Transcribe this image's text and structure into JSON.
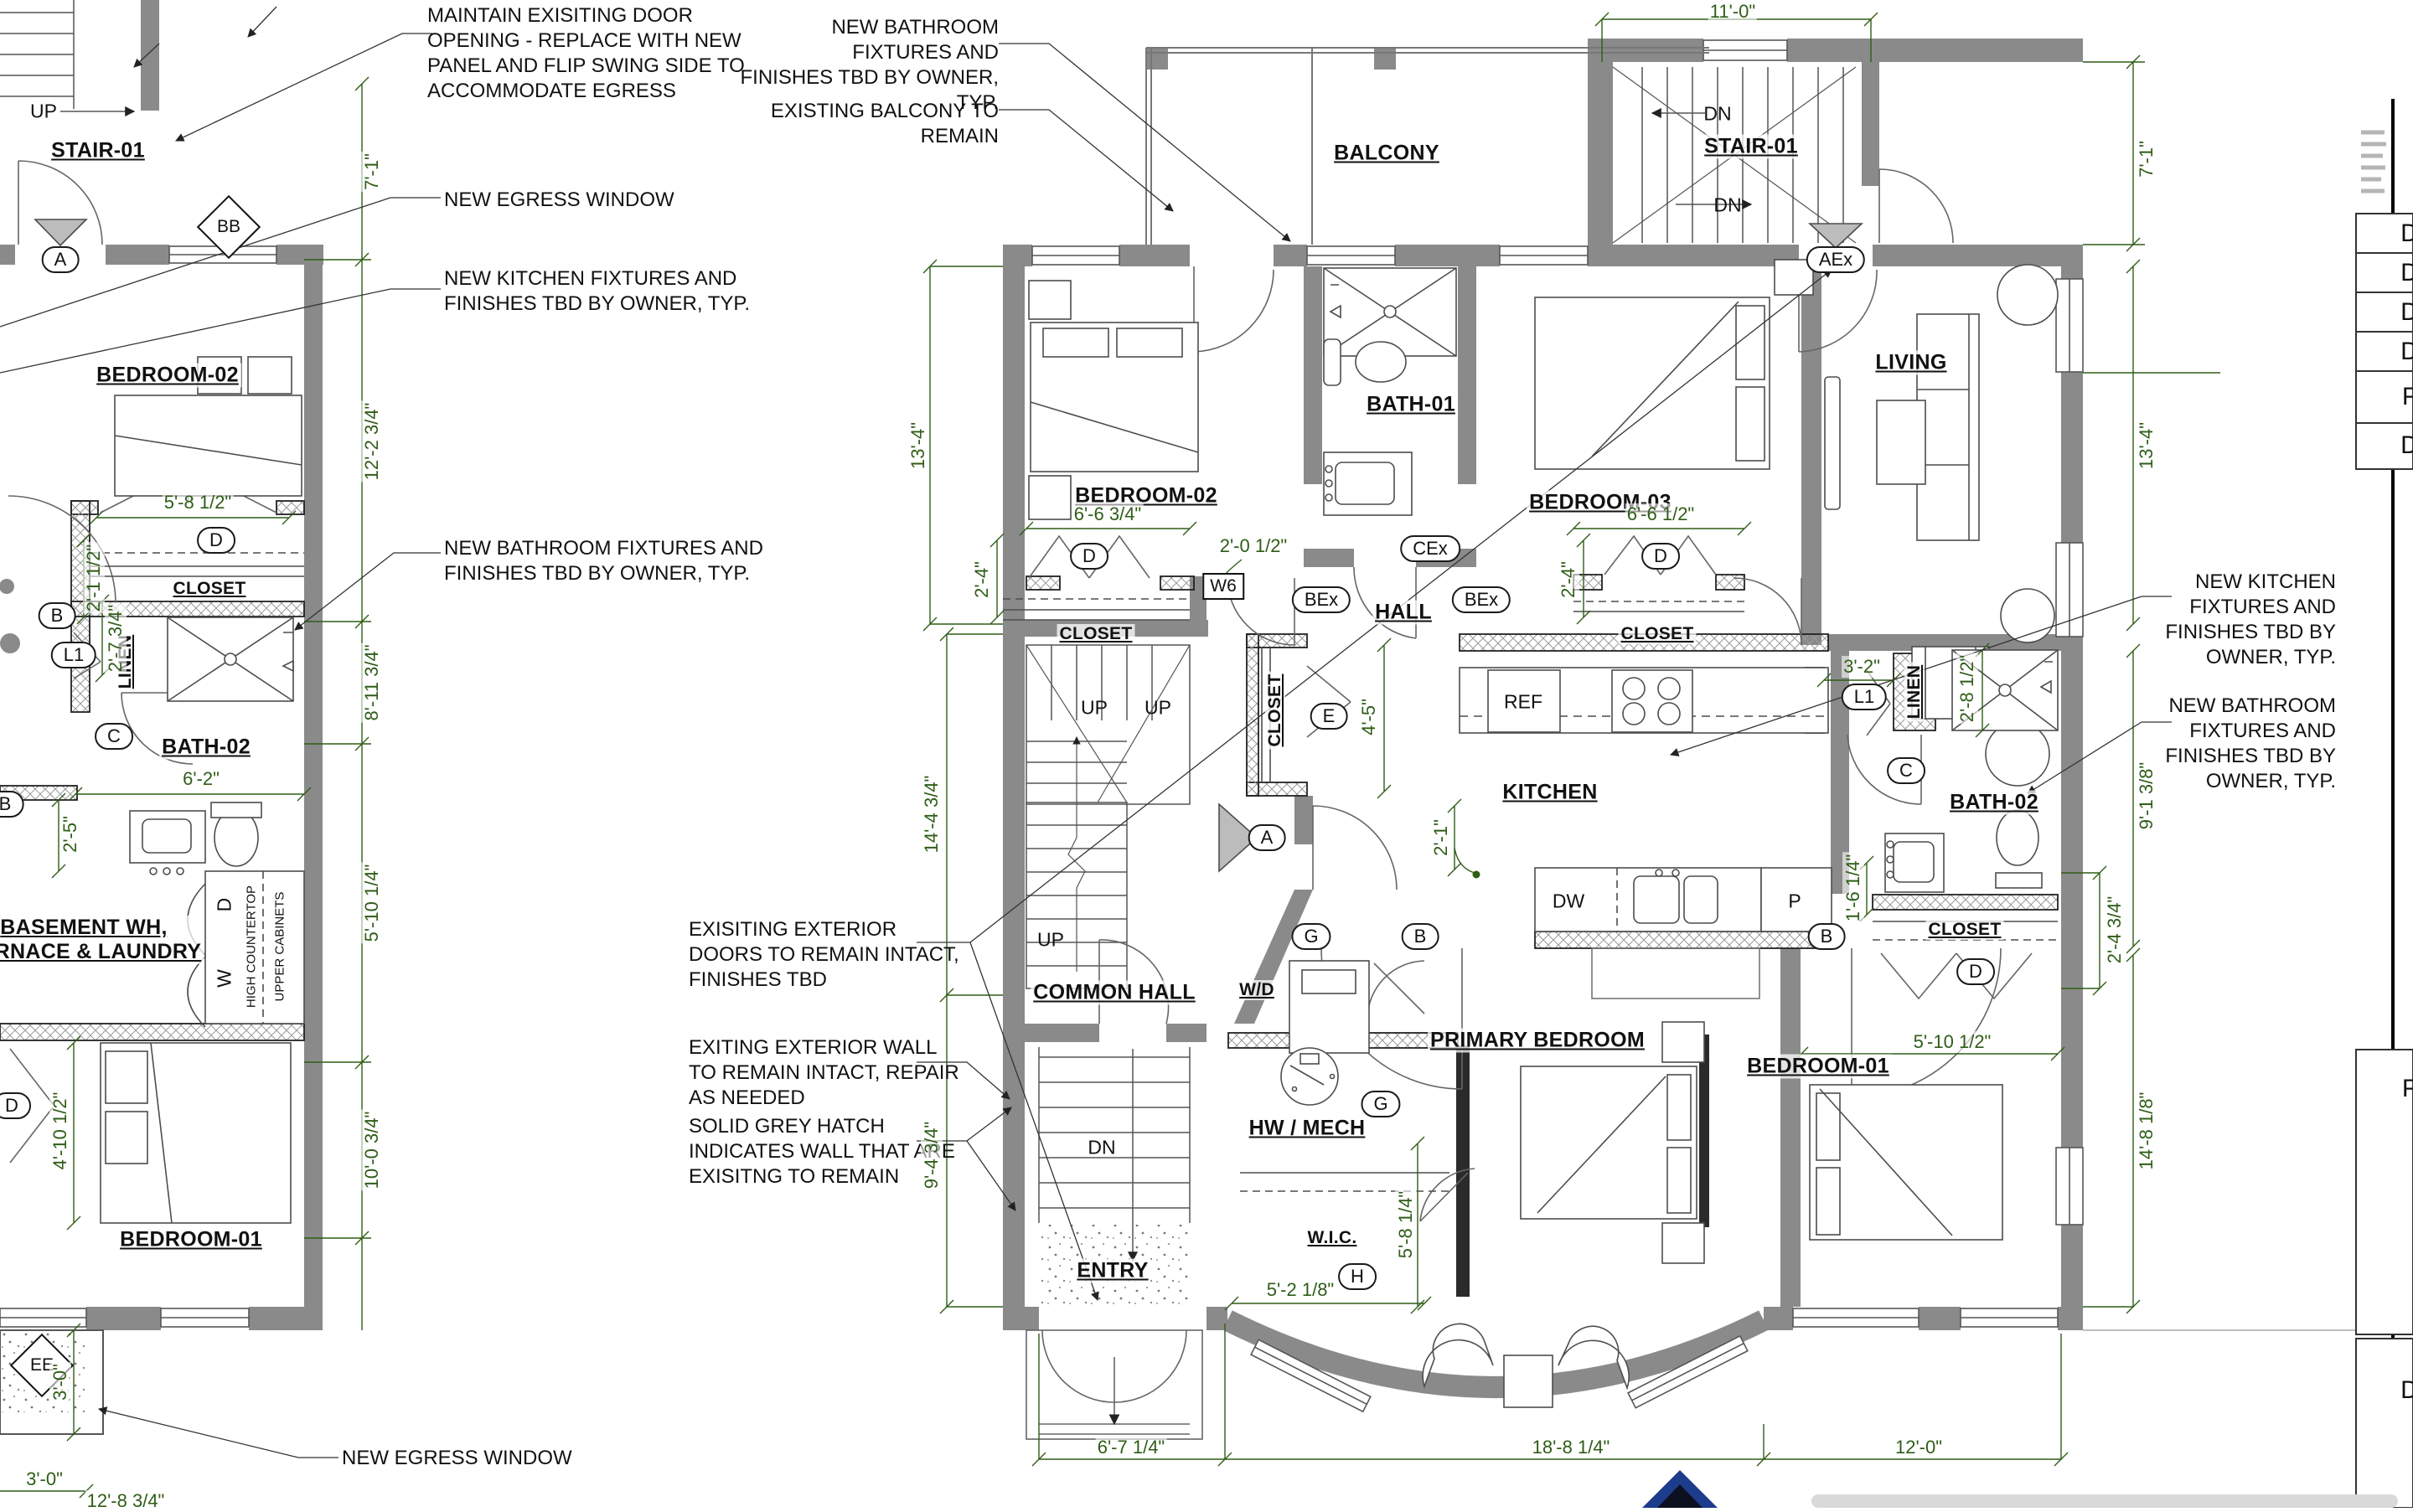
{
  "ann": {
    "maintain": "MAINTAIN EXISITING DOOR\nOPENING - REPLACE WITH NEW\nPANEL AND FLIP SWING SIDE TO\nACCOMMODATE EGRESS",
    "bath_top": "NEW BATHROOM FIXTURES AND\nFINISHES TBD BY OWNER, TYP.",
    "balcony": "EXISTING BALCONY TO REMAIN",
    "egress": "NEW EGRESS WINDOW",
    "kitchen_left": "NEW KITCHEN FIXTURES AND\nFINISHES TBD BY OWNER, TYP.",
    "bath_left": "NEW BATHROOM FIXTURES AND\nFINISHES TBD BY OWNER, TYP.",
    "ext_doors": "EXISITING EXTERIOR\nDOORS TO REMAIN INTACT,\nFINISHES TBD",
    "ext_wall": "EXITING EXTERIOR WALL\nTO REMAIN INTACT, REPAIR\nAS NEEDED",
    "grey_hatch": "SOLID GREY HATCH\nINDICATES WALL THAT ARE\nEXISITNG TO REMAIN",
    "kitchen_right": "NEW KITCHEN\nFIXTURES AND\nFINISHES TBD BY\nOWNER, TYP.",
    "bath_right": "NEW BATHROOM\nFIXTURES AND\nFINISHES TBD BY\nOWNER, TYP."
  },
  "rooms": {
    "stair01": "STAIR-01",
    "bedroom02": "BEDROOM-02",
    "bedroom03": "BEDROOM-03",
    "bedroom01": "BEDROOM-01",
    "primary": "PRIMARY BEDROOM",
    "bath01": "BATH-01",
    "bath02": "BATH-02",
    "closet": "CLOSET",
    "linen": "LINEN",
    "hall": "HALL",
    "common_hall": "COMMON HALL",
    "kitchen": "KITCHEN",
    "living": "LIVING",
    "balcony": "BALCONY",
    "wd": "W/D",
    "hw": "HW / MECH",
    "wic": "W.I.C.",
    "entry": "ENTRY",
    "basement": "BASEMENT WH,\nFURNACE & LAUNDRY"
  },
  "fix": {
    "ref": "REF",
    "dw": "DW",
    "p": "P",
    "w": "W",
    "d": "D",
    "hc": "HIGH COUNTERTOP",
    "uc": "UPPER CABINETS",
    "up": "UP",
    "dn": "DN"
  },
  "mk": {
    "a": "A",
    "b": "B",
    "c": "C",
    "d": "D",
    "e": "E",
    "g": "G",
    "h": "H",
    "l1": "L1",
    "aex": "AEx",
    "bex": "BEx",
    "cex": "CEx",
    "bb": "BB",
    "ee": "EE",
    "w6": "W6"
  },
  "dim": {
    "ft7_1": "7'-1\"",
    "ft12_2": "12'-2 3/4\"",
    "ft8_11": "8'-11 3/4\"",
    "ft5_10q": "5'-10 1/4\"",
    "ft10_0": "10'-0 3/4\"",
    "ft5_8h": "5'-8 1/2\"",
    "ft2_1h": "2'-1 1/2\"",
    "ft2_7": "2'-7 3/4\"",
    "ft6_2": "6'-2\"",
    "ft2_5": "2'-5\"",
    "ft4_10": "4'-10 1/2\"",
    "ft3_0": "3'-0\"",
    "ft12_8": "12'-8 3/4\"",
    "ft11_0": "11'-0\"",
    "ft13_4": "13'-4\"",
    "ft6_6t": "6'-6 3/4\"",
    "ft2_0h": "2'-0 1/2\"",
    "ft2_4": "2'-4\"",
    "ft6_6h": "6'-6 1/2\"",
    "ft3_2": "3'-2\"",
    "ft2_8h": "2'-8 1/2\"",
    "ft4_5": "4'-5\"",
    "ft2_1": "2'-1\"",
    "ft14_4": "14'-4 3/4\"",
    "ft9_4": "9'-4 3/4\"",
    "ft9_1": "9'-1 3/8\"",
    "ft1_6": "1'-6 1/4\"",
    "ft2_4t": "2'-4 3/4\"",
    "ft5_10h": "5'-10 1/2\"",
    "ft14_8": "14'-8 1/8\"",
    "ft5_8q": "5'-8 1/4\"",
    "ft5_2": "5'-2 1/8\"",
    "ft6_7": "6'-7 1/4\"",
    "ft18_8": "18'-8 1/4\"",
    "ft12_0": "12'-0\""
  },
  "titleblock": {
    "letters": [
      "D",
      "D",
      "D",
      "D",
      "F",
      "D",
      "F",
      "D"
    ]
  }
}
